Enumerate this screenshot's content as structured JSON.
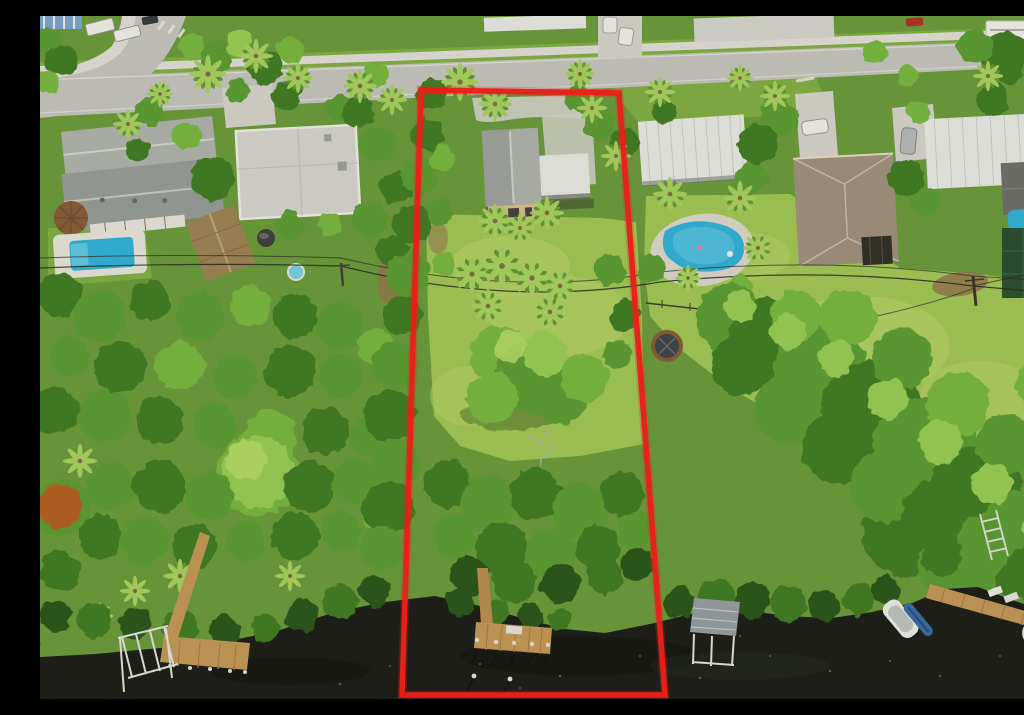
{
  "image": {
    "kind": "aerial drone photograph",
    "width_px": 1024,
    "height_px": 683,
    "description": "Bird's-eye view of a deep waterfront residential lot outlined in red: single-story gray-roof house near the street, long tree-filled yard running back to a dark canal with a private L-shaped wooden dock. Neighboring homes, two swimming pools, a hot tub, docks, boat lifts and boats flank the lot; a palm-lined street with sidewalks crosses the top; overhead power lines cross mid-frame."
  },
  "palette": {
    "boundary-red": "#e8201a",
    "road-gray": "#c7c7c0",
    "sidewalk-gray": "#e3e1d8",
    "concrete": "#d7d5cb",
    "curb-white": "#f0eee6",
    "base-green": "#6f9e3d",
    "grass-mid": "#84b244",
    "grass-bright": "#a4c957",
    "grass-sun": "#bcd76a",
    "green-darkest": "#2d5a1d",
    "green-dark": "#447f27",
    "green-mid": "#5f9f34",
    "green-light": "#7cba43",
    "green-lighter": "#9ccf55",
    "green-highlight": "#bade6a",
    "palm-light": "#a9d45f",
    "palm-dark": "#6b9a3c",
    "trunk-brown": "#8a6f4a",
    "dirt-brown": "#97794e",
    "roof-gray": "#b2b4ae",
    "roof-gray-dark": "#9b9f99",
    "roof-flat-white": "#d8d7cf",
    "roof-metal-white": "#eaebe5",
    "roof-rib": "#cdd0ca",
    "roof-brown": "#a3927f",
    "roof-brown-light": "#cfc0ab",
    "roof-silver": "#9aa0a2",
    "wall-tan": "#d9c28e",
    "window-dark": "#4c4440",
    "porch-dark": "#35332a",
    "water-dark": "#1f211a",
    "water-shadow": "#14160e",
    "water-glint": "#5d6b45",
    "dock-wood": "#c79b58",
    "dock-wood-dark": "#a98244",
    "metal-white": "#e6e5dc",
    "pool-blue": "#35b4d9",
    "pool-light": "#62c9e4",
    "hottub-rim": "#8a5f38",
    "hottub-top": "#43484a",
    "orange-bloom": "#c8571f",
    "car-white": "#f2f2ea",
    "car-red": "#b23527",
    "car-gray": "#b9bcba",
    "tarp-blue": "#4b80bf",
    "screen-green": "#274a2e",
    "awning-blue": "#7fa8cc",
    "wire-dark": "#2c2c24"
  },
  "boundary": {
    "label": "red property-line overlay",
    "points": "381,74 579,77 625,679 362,679",
    "stroke_width": "5.5"
  },
  "road": {
    "label": "residential street across top",
    "points": "0,62 1024,23 1024,49 0,101"
  },
  "sidewalk": {
    "points": "0,50 1024,12 1024,20 0,58"
  },
  "water": {
    "label": "dark canal across bottom",
    "path": "M0,641 L55,638 L120,632 L185,626 L240,614 L295,596 L345,586 L395,580 L440,590 L485,603 L525,613 L565,617 L610,608 L655,597 L700,593 L745,600 L792,602 L832,596 L872,587 L905,573 L938,571 L975,585 L1012,597 L1024,601 L1024,683 L0,683 Z"
  },
  "objects": {
    "subject_house": "single-story house: gray gable roof, white carport roof, tan gable wall with dark windows",
    "subject_dock": "L-shaped wooden dock with white-capped pilings inside the boundary",
    "left_pool": "rectangular blue pool with attached spa and white deck",
    "right_pool": "kidney-shaped blue pool with deck and dark metal fence",
    "hot_tub": "round covered hot tub behind right neighbor",
    "gazebo": "round brown thatched gazebo in left backyard",
    "boats": [
      "white runabout at neighbor dock",
      "blue kayak alongside",
      "covered white boat bottom-right corner"
    ],
    "boat_lifts": [
      "aluminum boat-lift frame bottom-left",
      "boat-lift frame under silver boathouse roof",
      "ladder rack on right bank"
    ],
    "vehicles": [
      "two white cars on north driveway",
      "white SUV",
      "gray SUV",
      "red car",
      "white trailer",
      "pickup trucks top-left",
      "blue-striped awning top-left corner"
    ],
    "utilities": "two utility poles with sagging power lines crossing the yards"
  }
}
